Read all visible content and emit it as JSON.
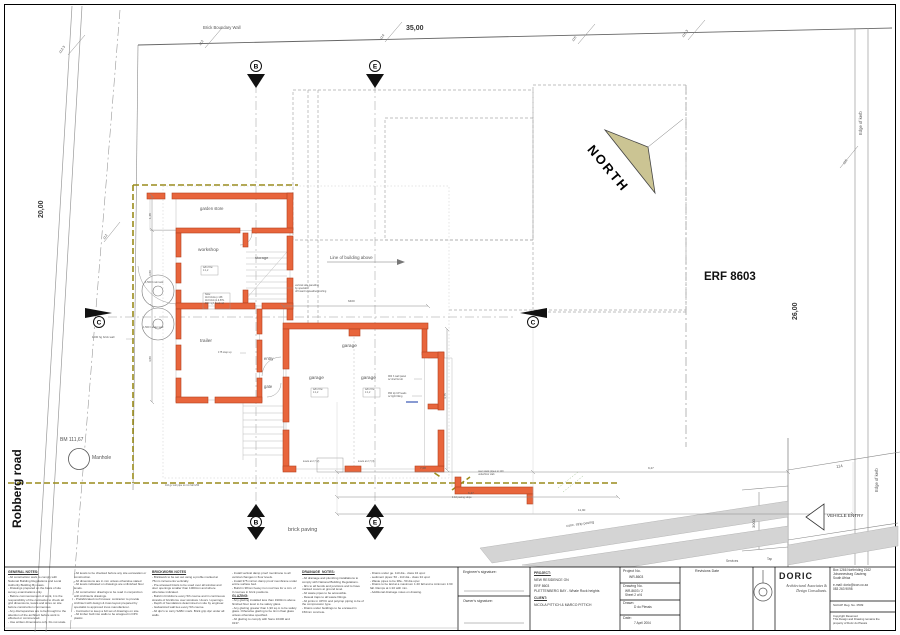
{
  "colors": {
    "wall_orange": "#e8653c",
    "wall_edge": "#b5421f",
    "boundary_dash_olive": "#9a8c1c",
    "north_arrow_tan": "#cbc493",
    "road_grey": "#d4d4d4"
  },
  "sheet": {
    "erf_label": "ERF 8603",
    "north_label": "NORTH",
    "road_label": "Robberg road",
    "boundary_wall_label": "Brick Boundary Wall",
    "brick_paving_label": "brick paving",
    "conc_strip_label": "conc. strip paving",
    "vehicle_entry_label": "VEHICLE ENTRY",
    "edge_of_kerb_1": "Edge of kerb",
    "edge_of_kerb_2": "Edge of kerb",
    "services_label": "Services",
    "tap_label": "Tap",
    "manhole_label": "Manhole",
    "benchmark_label": "BM 111,67",
    "line_of_building_above": "Line of building above"
  },
  "markers": {
    "b": "B",
    "e": "E",
    "c": "C"
  },
  "beacons": {
    "tl": "112.3",
    "l": "112",
    "t1": "113",
    "t2": "114",
    "t3": "115",
    "tr": "115.3",
    "r1": "115",
    "r2": "114"
  },
  "dims": {
    "top_width": "35,00",
    "left_height": "20,00",
    "right_height": "26,00",
    "vehicle_entry": "3000",
    "left1": "1,48",
    "left2": "3,80",
    "left3": "4,80",
    "bottom1": "7,08",
    "bottom1b": "9,47",
    "bottom2": "6,47",
    "bottom3": "11,90",
    "garage_w": "6400",
    "garage_h": "4,75"
  },
  "rooms": {
    "garden_store": "garden store",
    "workshop": "workshop",
    "storage": "storage",
    "trailer": "trailer",
    "entry": "entry",
    "gate": "gate",
    "garage1": "garage",
    "garage2": "garage",
    "garage3": "garage",
    "ffl_box": "w/b 2 bw\n1:1,2",
    "note_box": "Note:\n110 bricks p 138\n110 brick pl & BTL\n900 high flood rail"
  },
  "ann": {
    "panelling": "vertical side panelling\nby specialist\noff board to weatherproofing",
    "wall_panel": "900 h wall panel\nw/ shelf & tub",
    "rw_pipe": "RW dp UP leads\nw/ light fitting",
    "stack_pipes": "over stack pipes to 110\nunderfloor slab",
    "soil_pipe": "110 gv soil pipe to min fall 1/60",
    "paving_slope": "1:10 paving slope",
    "brick_wall": "1200 hg brick wall",
    "rain_tank": "1,500 l rain tank",
    "water_tank": "1,500 l water tank",
    "step_up": "175 step up",
    "levels2": "levels at 2,7 (2)",
    "levels3": "levels at 2,7 (3)"
  },
  "notes": {
    "general": {
      "title": "GENERAL NOTES:",
      "body": "- All construction work to comply with National Building Regulations and Local Authority Building By-Laws.\n- Drawings prepared on the basis of site survey examinations only.\n- Before commencement of work, it is the responsibility of the contractor to check all grid dimensions, levels and sizes on site before construction commences.\n- Any discrepancies are to be brought to the attention of the architect before work is effected or commenced.\n- Use written dimensions only. Do not scale."
    },
    "general2": {
      "body": "- All levels to be checked before any site excavation or construction.\n- All dimensions are in mm unless otherwise stated\n- All levels indicated on drawings are unfinished floor levels.\n- All construction drawings to be read in conjunction with Architects drawings.\n- Prefabricated roof trusses: contractor to provide Architect with design & truss layout prepared by specialist to approved truss manufacturer.\n- Contractor to keep a full set of drawings on site.\n- All timber built into walls to be wrapped in DPC plastic."
    },
    "brickwork": {
      "title": "BRICKWORK NOTES",
      "body": "- Brickwork to be set out using a profile marked at 75mm increments vertically.\n- Pre-stressed lintols to be used over all window and door openings smaller than 1000mm and where otherwise indicated.\n- Build in brickforce every 5th course and in continuous strands of brickforce over windows / doors / openings.\n- Depth of foundations determined on site by engineer.\n- Galvanized wall ties every 5th course.\n- All dpc's to carry SABC mark. Brick grip dpc under all walls."
    },
    "damp_glazing": {
      "body1": "- Install vertical damp proof membrane to all vertical changes in floor levels.\n- Install 375 micron damp proof membrane under entire surface bed.\n- Build in 38mm heavy iron roof ties for a min. of 3 courses in brick positions.",
      "glazing_title": "GLAZING:",
      "body2": "- Any glazing installed less than 1900mm above finished floor level to be safety glass.\n- Any glazing greater than 1,90 sq.m to be safety glass. Otherwise glazing to be 4mm float glass unless otherwise specified.\n- All glazing to comply with Sans 10400 and 0137."
    },
    "drainage": {
      "title": "DRAINAGE  NOTES:",
      "body": "- All drainage and plumbing installations to comply with National Building Regulations.\n- IE's to all bends and junctions and to have marked covers at ground level.\n- All waste pipes to be accessible.\n- Reseal traps to all waste fittings.\n- All joints in UPVC and polycop piping to be of the compression type.\n- Drains under buildings to be encased in 150mm concrete."
    },
    "drainage2": {
      "body": "- Drains under ge. 110 dia - class 34 upvc\n- sediment pipes: 50 - 110 dia - class 34 upvc\n- Waste pipes to be 38a - 50 dia upvc\n- Drains to be laid at a maximum 1:40 fall and a minimum 1:60 fall. Ramps at 1:10 with min.\n- Additional drainage notes on drawing."
    }
  },
  "titleblock": {
    "engineer_sig": "Engineer's signature:",
    "owner_sig": "Owner's signature:",
    "project_label": "PROJECT:",
    "project_line1": "NEW RESIDENCE ON",
    "project_line2": "ERF 8603",
    "project_line3": "PLETTENBERG BAY    -  Whale Rock heights",
    "client_label": "CLIENT:",
    "client_name": "NICOLA  PITTICH  &  MARCO  PITTICH",
    "project_no_label": "Project No.",
    "project_no": "WR-8603",
    "drawing_no_label": "Drawing No.",
    "drawing_no": "WR-8603 / 2",
    "sheet_no": "Sheet 2 of 6",
    "drawn_label": "Drawn:",
    "drawn": "D du Plessis",
    "date_label": "Date:",
    "date": "7 April 2004",
    "revisions_label": "Revisions  Date",
    "doric": {
      "name": "DORIC",
      "tagline": "Architectural Associates &\nDesign Consultants.",
      "address": "Box 1266 Northriding 2162\nJohannesburg   Gauteng\nSouth Africa",
      "contact": "e-mail:  doric@icon.co.za\n083 263 9098",
      "reg": "SACAP Reg. No.  0509",
      "copyright": "Copyright Reserved\nThis Design and Drawing remains the\nproperty of Doric du Plessis"
    }
  }
}
